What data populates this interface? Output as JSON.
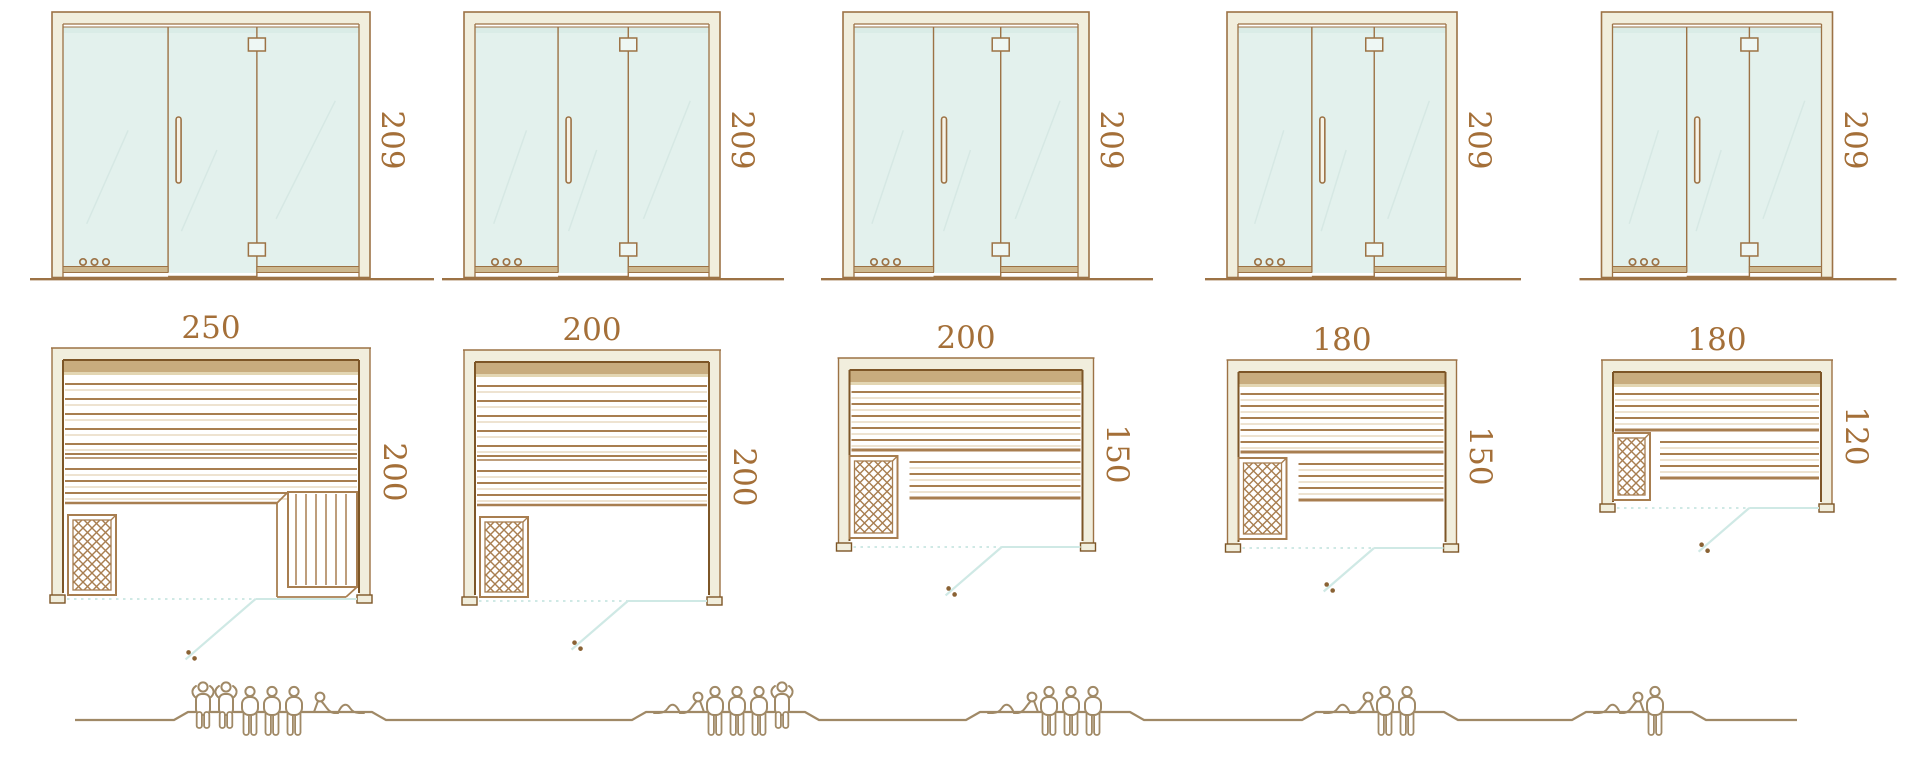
{
  "page": {
    "background": "#ffffff",
    "description": "Sauna cabin size comparison: five models with glass front elevation, floor plan and capacity figures"
  },
  "colors": {
    "outline": "#9c7245",
    "outline_dark": "#7d5627",
    "cream": "#f1eedd",
    "tan_band": "#c8ac7e",
    "tan_band_light": "#e3d6b3",
    "slat": "#a87e50",
    "slat_light": "#dcc7a3",
    "glass": "#e3f1ed",
    "glass_reflection": "#d4e7e2",
    "rail": "#cdb88f",
    "hinge_fill": "#eef7f4",
    "swing_line": "#cfe9e5",
    "dimension_text": "#a46f38",
    "people": "#a08966",
    "handle_dot": "#8a6234"
  },
  "icons": {
    "heater": "heater-lattice-icon",
    "door_handle": "door-handle-icon",
    "hinge": "hinge-icon",
    "control_dots": "control-dots-icon",
    "door_swing": "door-swing-icon",
    "person_standing": "person-standing-icon",
    "person_sitting": "person-sitting-icon",
    "person_lying": "person-lying-icon"
  },
  "models": [
    {
      "id": "model-1",
      "elevation_height": "209",
      "width": "250",
      "depth": "200",
      "capacity": {
        "standing": 2,
        "sitting": 3,
        "lying": 1
      }
    },
    {
      "id": "model-2",
      "elevation_height": "209",
      "width": "200",
      "depth": "200",
      "capacity": {
        "standing": 1,
        "sitting": 3,
        "lying": 1
      }
    },
    {
      "id": "model-3",
      "elevation_height": "209",
      "width": "200",
      "depth": "150",
      "capacity": {
        "standing": 0,
        "sitting": 3,
        "lying": 1
      }
    },
    {
      "id": "model-4",
      "elevation_height": "209",
      "width": "180",
      "depth": "150",
      "capacity": {
        "standing": 0,
        "sitting": 2,
        "lying": 1
      }
    },
    {
      "id": "model-5",
      "elevation_height": "209",
      "width": "180",
      "depth": "120",
      "capacity": {
        "standing": 0,
        "sitting": 1,
        "lying": 1
      }
    }
  ]
}
